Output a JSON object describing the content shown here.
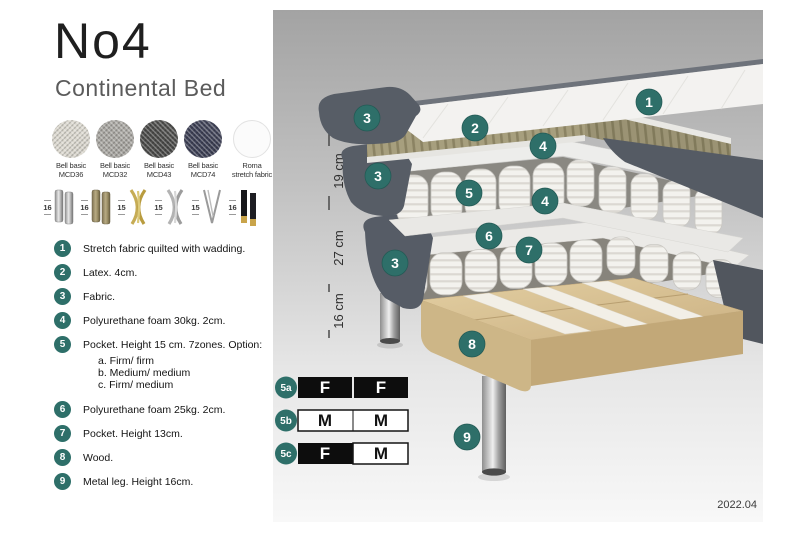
{
  "title": {
    "name": "No4",
    "subtitle": "Continental Bed"
  },
  "fabric_swatches": [
    {
      "line1": "Bell basic",
      "line2": "MCD36",
      "color": "#dcd9d0"
    },
    {
      "line1": "Bell basic",
      "line2": "MCD32",
      "color": "#a9a7a2"
    },
    {
      "line1": "Bell basic",
      "line2": "MCD43",
      "color": "#4c4c4a"
    },
    {
      "line1": "Bell basic",
      "line2": "MCD74",
      "color": "#3e4156"
    },
    {
      "line1": "Roma",
      "line2": "stretch fabric",
      "color": "#fbfbfb"
    }
  ],
  "leg_options": [
    {
      "height": "16",
      "style": "cylinder-silver"
    },
    {
      "height": "16",
      "style": "cylinder-bronze"
    },
    {
      "height": "15",
      "style": "cross-gold"
    },
    {
      "height": "15",
      "style": "cross-silver"
    },
    {
      "height": "15",
      "style": "hairpin-metal"
    },
    {
      "height": "16",
      "style": "square-black-gold"
    }
  ],
  "spec_list": [
    {
      "num": "1",
      "text": "Stretch fabric quilted with wadding."
    },
    {
      "num": "2",
      "text": "Latex. 4cm."
    },
    {
      "num": "3",
      "text": "Fabric."
    },
    {
      "num": "4",
      "text": "Polyurethane foam 30kg. 2cm."
    },
    {
      "num": "5",
      "text": "Pocket. Height 15 cm. 7zones. Option:",
      "options": [
        "a. Firm/ firm",
        "b. Medium/ medium",
        "c. Firm/ medium"
      ]
    },
    {
      "num": "6",
      "text": "Polyurethane foam 25kg. 2cm."
    },
    {
      "num": "7",
      "text": "Pocket. Height 13cm."
    },
    {
      "num": "8",
      "text": "Wood."
    },
    {
      "num": "9",
      "text": "Metal leg. Height 16cm."
    }
  ],
  "diagram": {
    "dimension_labels": [
      "6",
      "19 cm",
      "27 cm",
      "16 cm"
    ],
    "callouts": [
      "1",
      "2",
      "3",
      "4",
      "3",
      "5",
      "4",
      "6",
      "7",
      "3",
      "8",
      "9"
    ],
    "firmness_options": [
      {
        "id": "5a",
        "cells": [
          {
            "letter": "F",
            "tone": "dark"
          },
          {
            "letter": "F",
            "tone": "dark"
          }
        ]
      },
      {
        "id": "5b",
        "cells": [
          {
            "letter": "M",
            "tone": "light"
          },
          {
            "letter": "M",
            "tone": "light"
          }
        ]
      },
      {
        "id": "5c",
        "cells": [
          {
            "letter": "F",
            "tone": "dark"
          },
          {
            "letter": "M",
            "tone": "light"
          }
        ]
      }
    ],
    "version": "2022.04"
  },
  "colors": {
    "accent_teal": "#2E6F69",
    "dark_fabric": "#575D66",
    "latex": "#A79F7E",
    "wood": "#D7C295",
    "background_top": "#A3A3A3",
    "background_bottom": "#F8F8F8"
  }
}
